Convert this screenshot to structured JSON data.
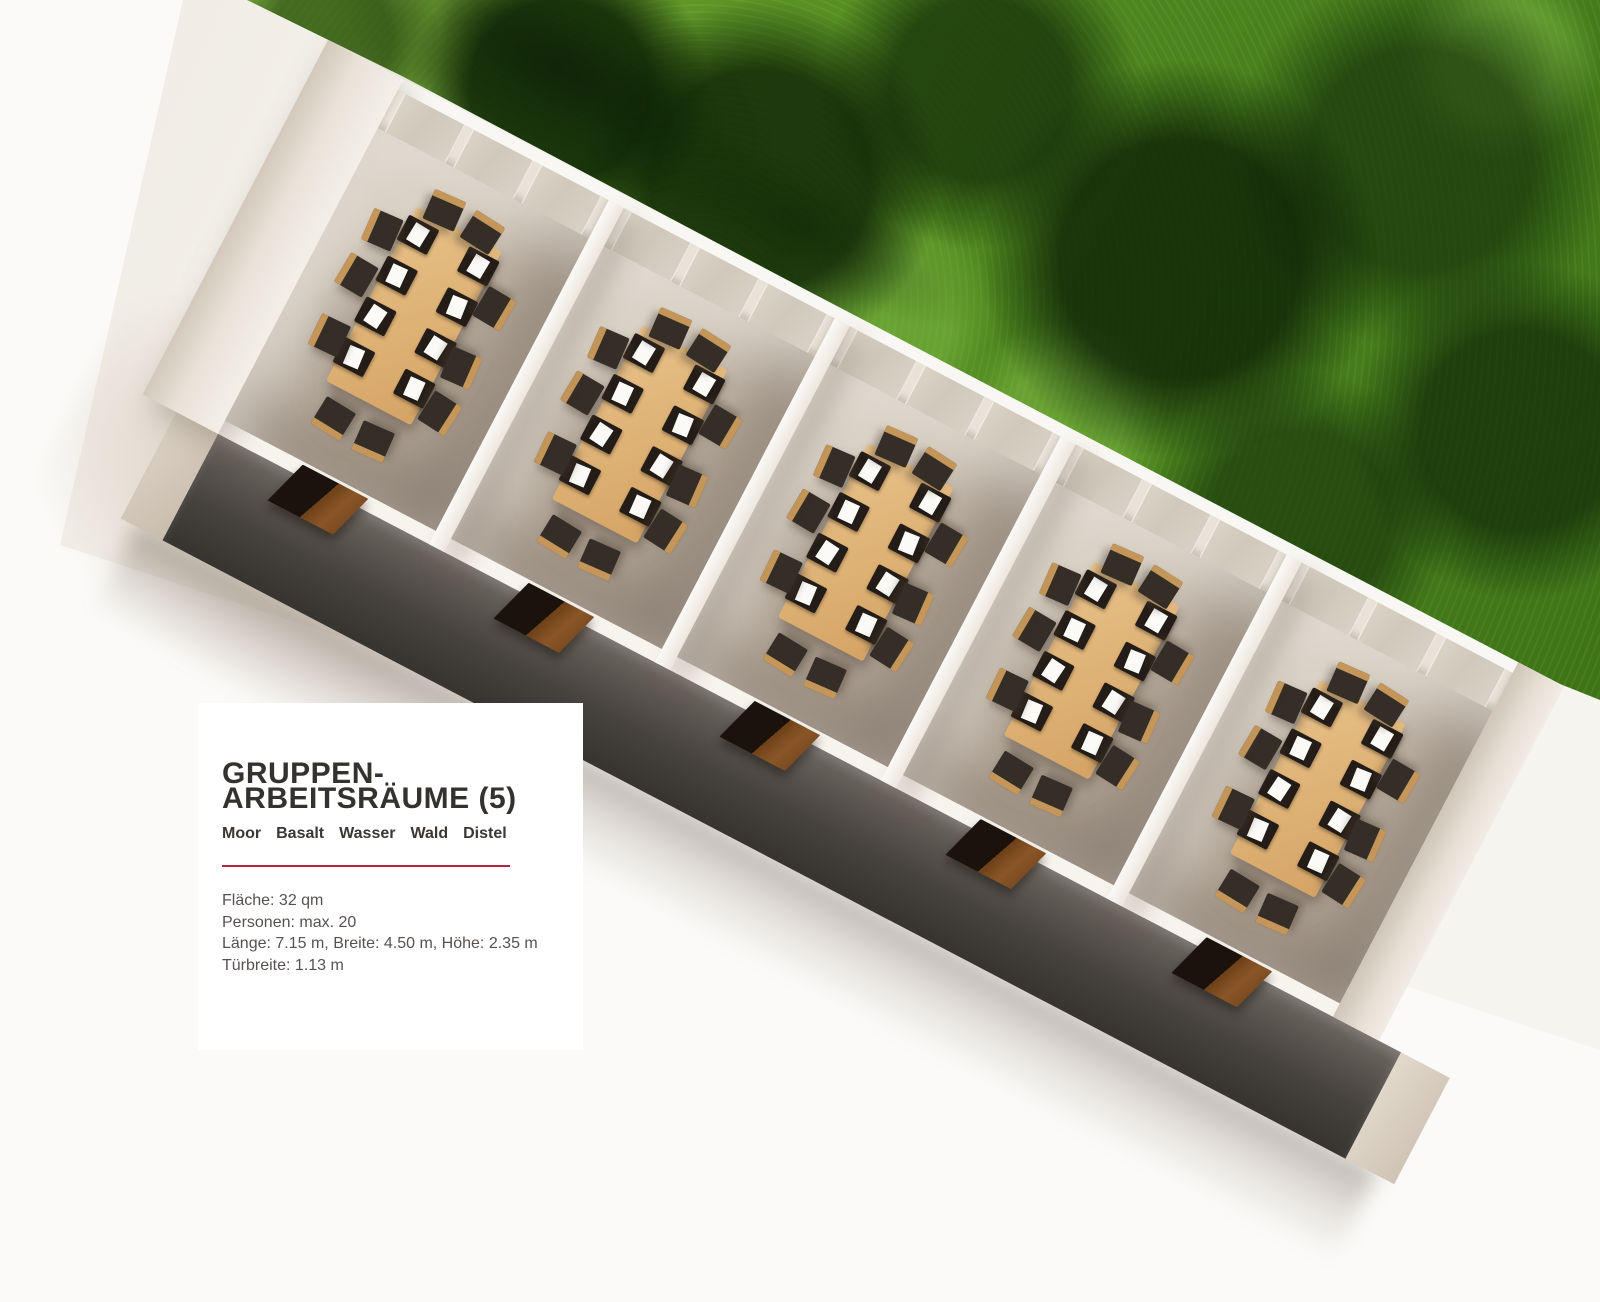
{
  "panel": {
    "title_line1": "GRUPPEN-",
    "title_line2": "ARBEITSRÄUME (5)",
    "room_names": [
      "Moor",
      "Basalt",
      "Wasser",
      "Wald",
      "Distel"
    ],
    "details": [
      "Fläche: 32 qm",
      "Personen: max. 20",
      "Länge: 7.15 m, Breite: 4.50 m, Höhe: 2.35 m",
      "Türbreite: 1.13 m"
    ],
    "accent_color": "#b5243f"
  },
  "scene": {
    "rooms_count": 5,
    "colors": {
      "forest_green": "#4a831c",
      "meadow_green": "#8ab946",
      "floor_taupe": "#b9ad9f",
      "wall_white": "#f5f1ea",
      "front_wall_dark": "#46423d",
      "table_wood": "#d9ab6e",
      "chair_dark": "#352e27",
      "door_brown": "#7a4a20",
      "page_white": "#fbfaf8"
    }
  }
}
